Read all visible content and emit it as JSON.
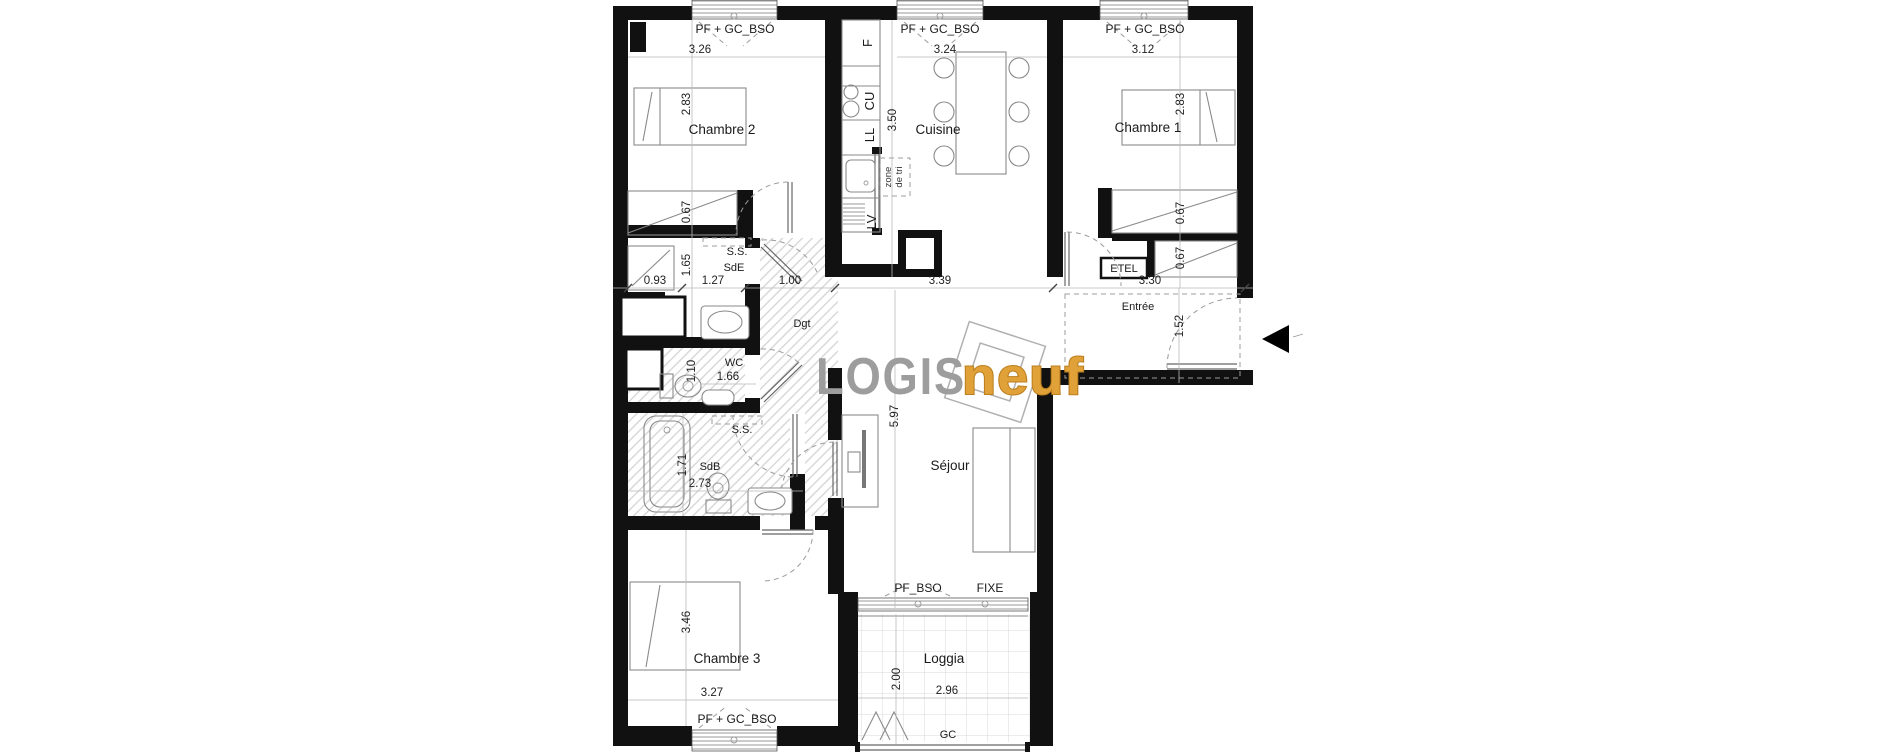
{
  "brand": {
    "logis": "LOGIS",
    "neuf": "neuf",
    "logis_color": "#9d9d9d",
    "neuf_color": "#e0a139",
    "neuf_stroke": "#bc7f1e"
  },
  "colors": {
    "wall": "#111111",
    "hatch": "#d9d9d9",
    "arrow": "#000000"
  },
  "windows": {
    "top1": "PF + GC_BSO",
    "top2": "PF + GC_BSO",
    "top3": "PF + GC_BSO",
    "chambre3": "PF + GC_BSO",
    "sejour_left": "PF_BSO",
    "sejour_right": "FIXE"
  },
  "rooms": {
    "chambre2": {
      "label": "Chambre 2",
      "dim_w": "3.26",
      "dim_h": "2.83",
      "dim_closet": "0.67"
    },
    "cuisine": {
      "label": "Cuisine",
      "dim_w": "3.24",
      "dim_h": "3.50"
    },
    "chambre1": {
      "label": "Chambre 1",
      "dim_w": "3.12",
      "dim_h": "2.83",
      "dim_closet1": "0.67",
      "dim_closet2": "0.67"
    },
    "sde": {
      "label": "SdE",
      "ss": "S.S.",
      "dim_h": "1.65"
    },
    "wc": {
      "label": "WC",
      "dim_h": "1.10",
      "dim_w": "1.66"
    },
    "sdb": {
      "label": "SdB",
      "ss": "S.S.",
      "dim_h": "1.71",
      "dim_w": "2.73"
    },
    "dgt": {
      "label": "Dgt"
    },
    "sejour": {
      "label": "Séjour",
      "dim_h": "5.97"
    },
    "entree": {
      "label": "Entrée",
      "dim_h": "1.52"
    },
    "etel": {
      "label": "ETEL"
    },
    "chambre3": {
      "label": "Chambre 3",
      "dim_h": "3.46",
      "dim_w": "3.27"
    },
    "loggia": {
      "label": "Loggia",
      "dim_h": "2.00",
      "dim_w": "2.96",
      "rail": "GC"
    }
  },
  "dimline": {
    "d1": "0.93",
    "d2": "1.27",
    "d3": "1.00",
    "d4": "3.39",
    "d5": "3.30"
  },
  "kitchen": {
    "fridge": "F",
    "hob": "CU",
    "washer": "LL",
    "dishwasher": "LV",
    "zone_line1": "zone",
    "zone_line2": "de tri"
  }
}
